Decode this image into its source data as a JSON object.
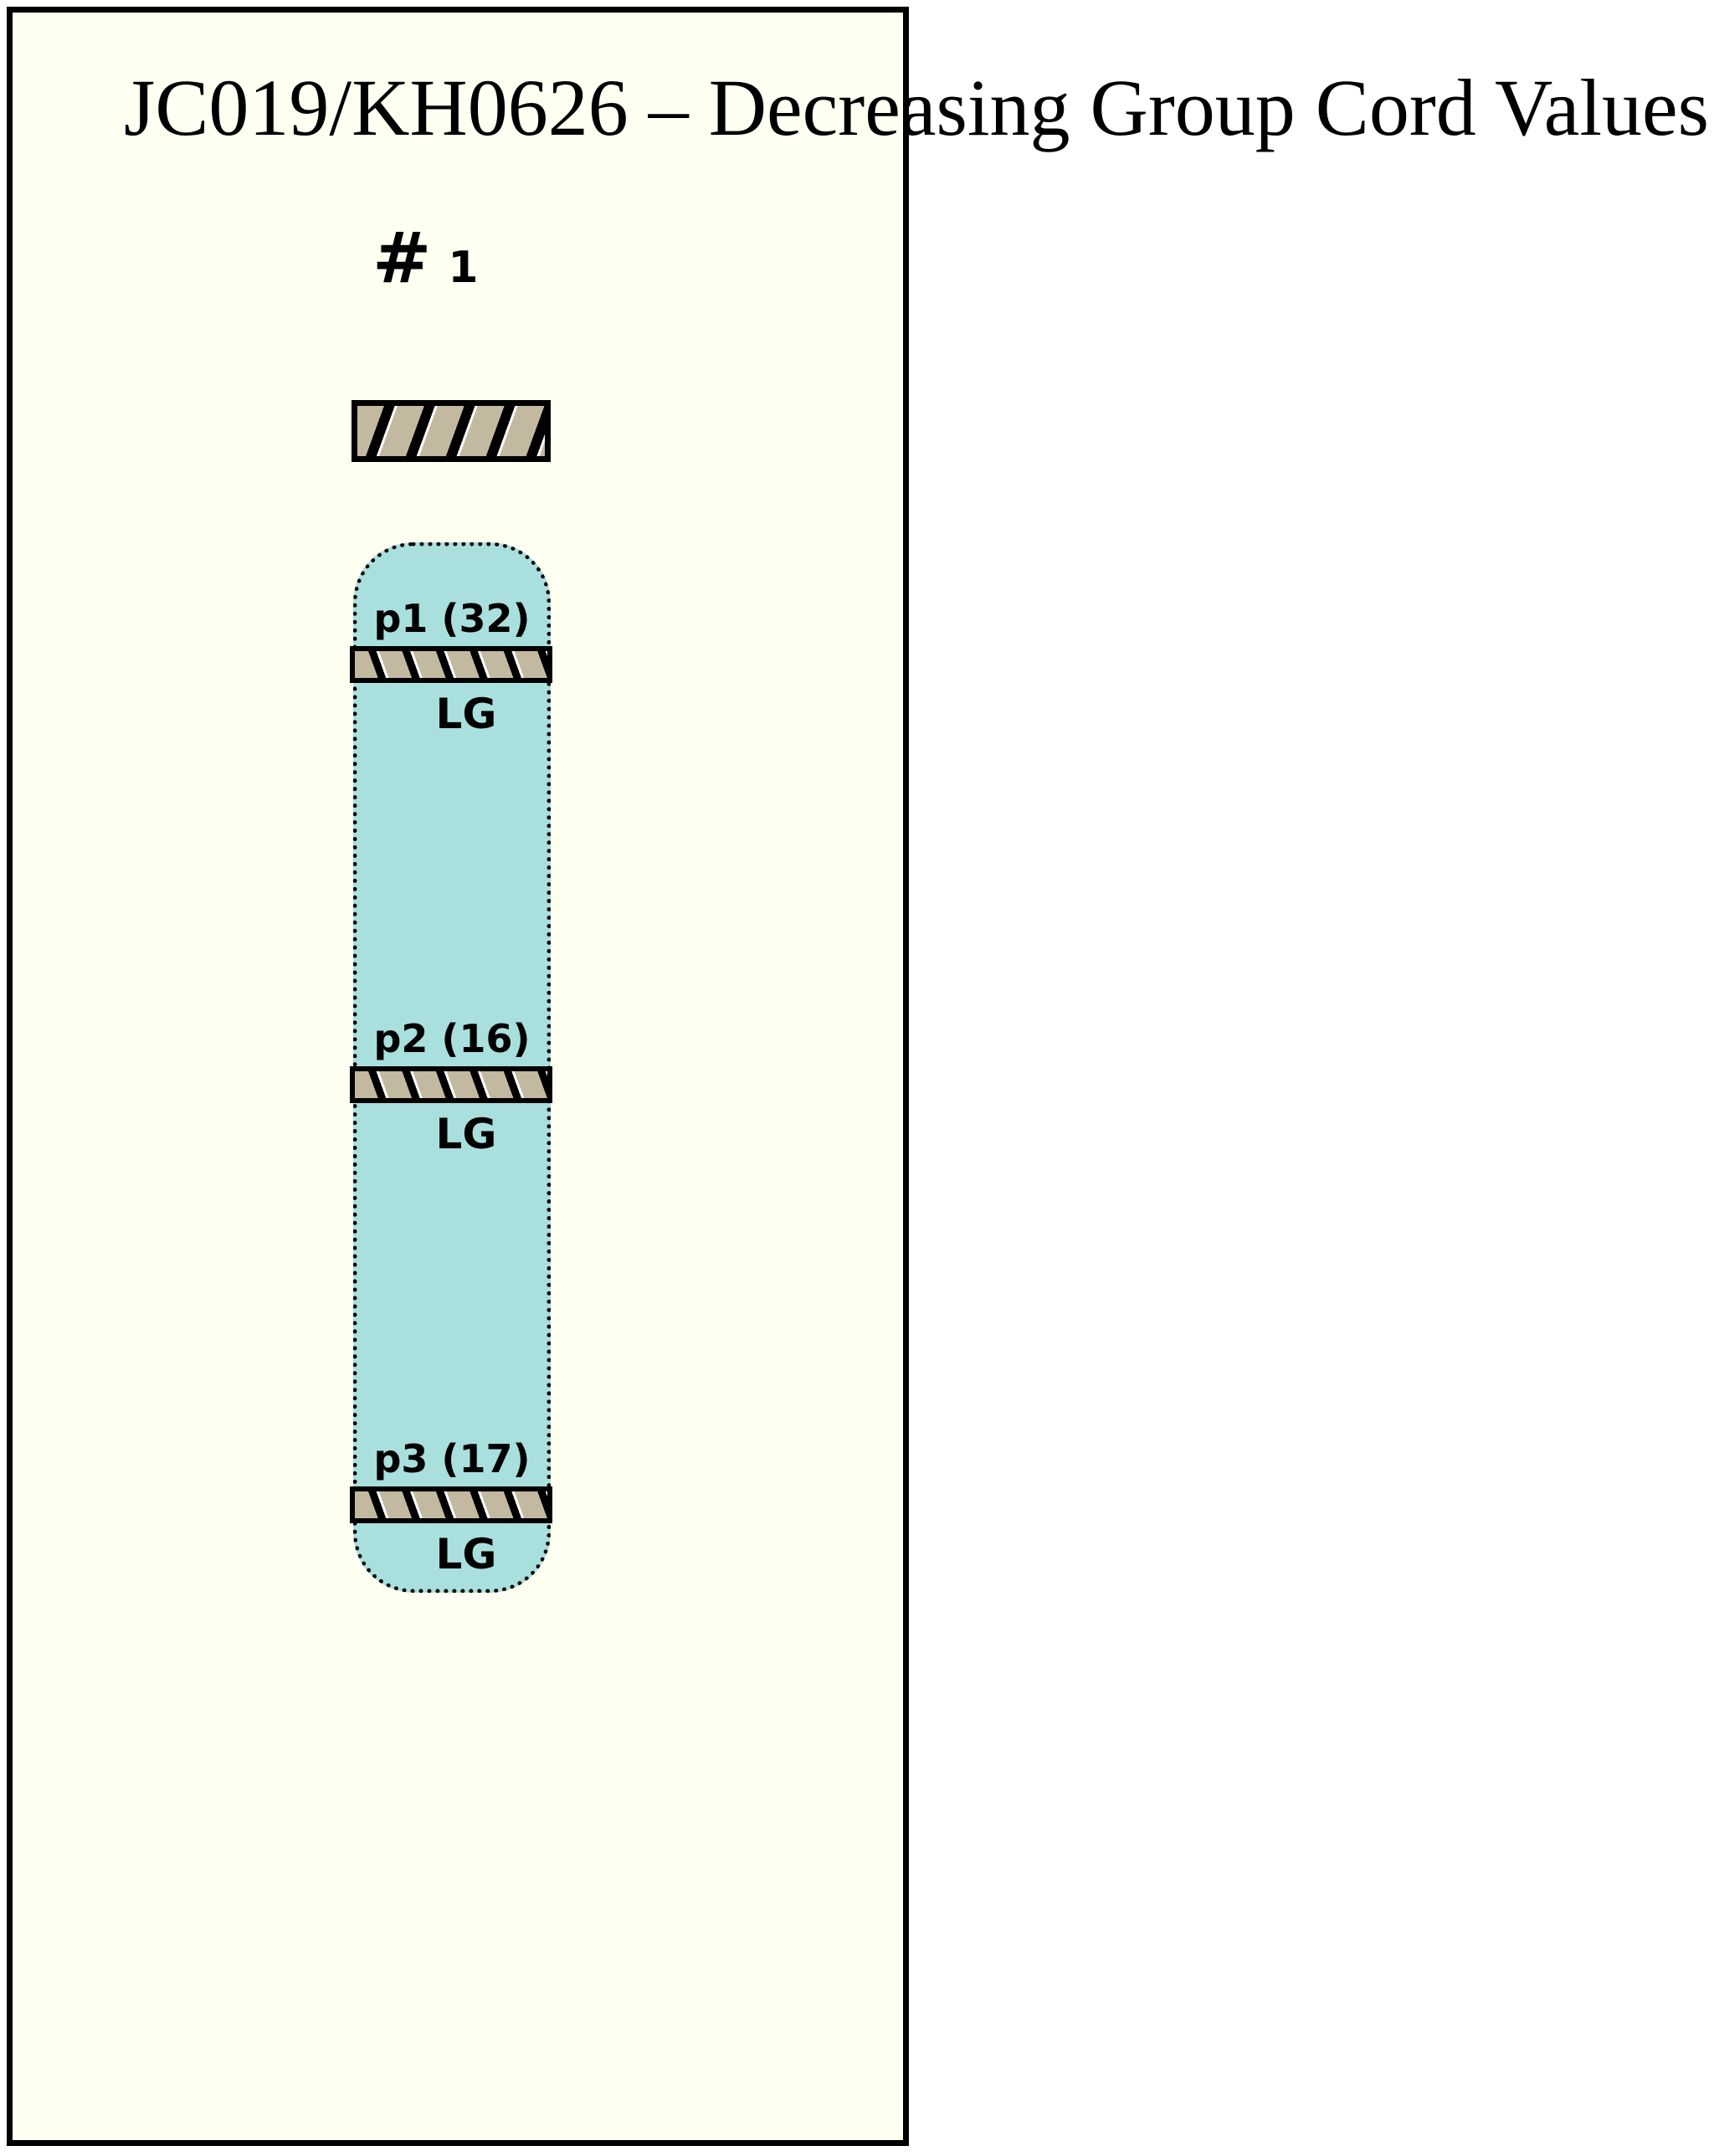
{
  "title": "JC019/KH0626 – Decreasing Group Cord Values",
  "chromosome": {
    "number_prefix": "#",
    "number": "1",
    "segments": [
      {
        "label": "p1 (32)",
        "group_label": "LG"
      },
      {
        "label": "p2 (16)",
        "group_label": "LG"
      },
      {
        "label": "p3 (17)",
        "group_label": "LG"
      }
    ]
  },
  "colors": {
    "background": "#ffffff",
    "panel_fill": "#fffff2",
    "group_fill": "#a9e0dd",
    "marker_fill": "#c3b9a0",
    "outline": "#000000"
  }
}
